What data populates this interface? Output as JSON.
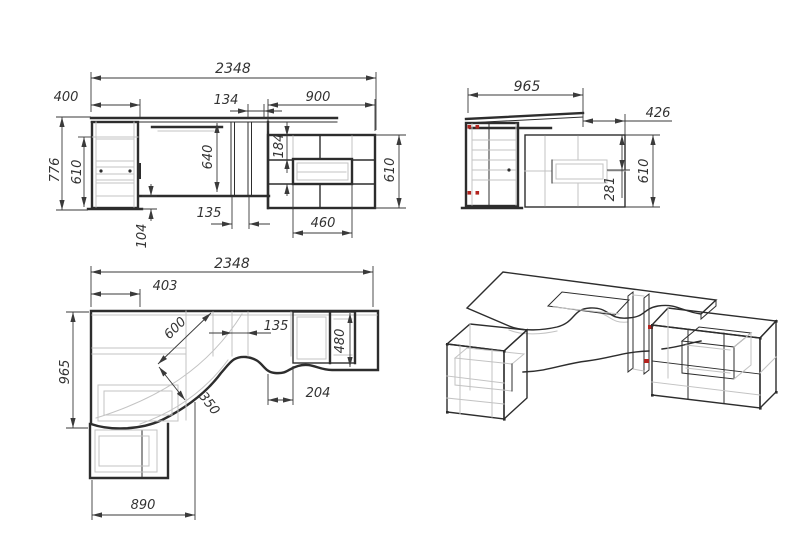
{
  "drawing": {
    "front_view": {
      "width_total": "2348",
      "width_left": "400",
      "width_gap": "134",
      "width_right": "900",
      "height_total": "776",
      "height_left_cabinet": "610",
      "height_niche": "640",
      "drawer_top_offset": "184",
      "height_right_cabinet": "610",
      "gap_bottom": "135",
      "drawer_width": "460",
      "plinth_height": "104"
    },
    "side_view": {
      "depth_total": "965",
      "depth_shelf": "426",
      "shelf_offset": "281",
      "height_cabinet": "610"
    },
    "plan_view": {
      "width_total": "2348",
      "left_offset": "403",
      "corner_radius": "600",
      "curve_radius": "350",
      "gap": "135",
      "depth_right": "480",
      "depth_left": "965",
      "edge_offset": "204",
      "pedestal_width": "890"
    },
    "colors": {
      "line": "#2d2d2d",
      "dim": "#3a3a3a",
      "light": "#c3c3c3",
      "accent": "#b3241f",
      "background": "#ffffff"
    }
  }
}
